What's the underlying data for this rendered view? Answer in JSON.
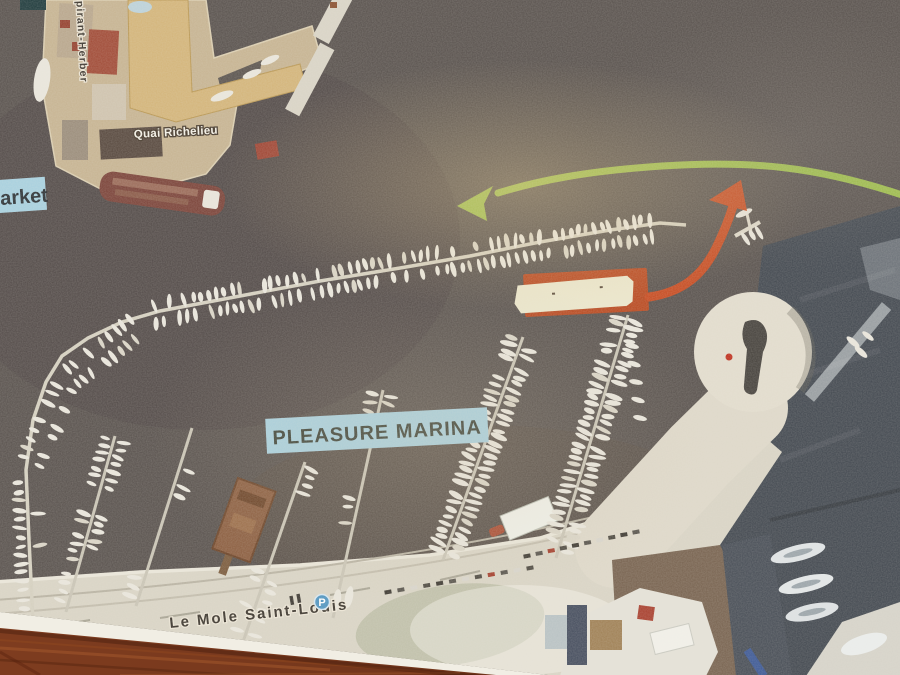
{
  "labels": {
    "market_partial": "arket",
    "aspirant_quay": "spirant-Herber",
    "quai_richelieu": "Quai Richelieu",
    "pleasure_marina": "PLEASURE MARINA",
    "mole_saint_louis": "Le Mole Saint-Louis",
    "parking": "P"
  },
  "colors": {
    "label_background": "#a7d0df",
    "label_text": "#353c38",
    "green_arrow": "#9cbc49",
    "red_arrow": "#c64a20",
    "highlight_box": "#b8481f",
    "water": "#58514d",
    "paper": "#f1eee4",
    "wood_table": "#7c3a20",
    "parking_icon": "#4f94c0",
    "mole_surface": "#d9d4c5"
  },
  "annotations": {
    "green_arrow_name": "green-route-arrow",
    "red_arrow_name": "red-turn-arrow",
    "highlight_name": "berth-highlight-box"
  }
}
